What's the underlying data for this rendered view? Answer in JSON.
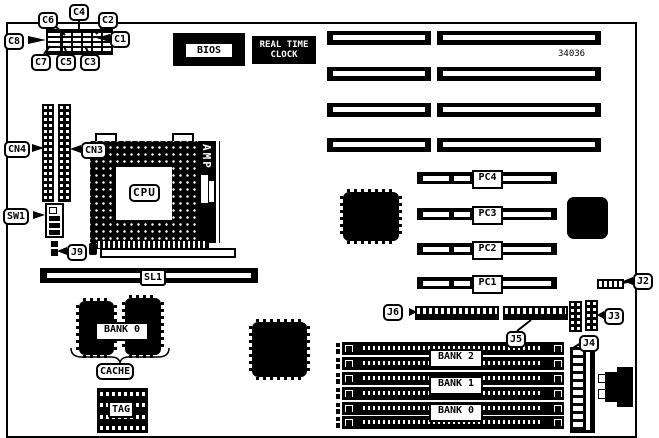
{
  "part_number": "34036",
  "jumper_labels": {
    "c1": "C1",
    "c2": "C2",
    "c3": "C3",
    "c4": "C4",
    "c5": "C5",
    "c6": "C6",
    "c7": "C7",
    "c8": "C8"
  },
  "connector_labels": {
    "cn3": "CN3",
    "cn4": "CN4",
    "sw1": "SW1",
    "j2": "J2",
    "j3": "J3",
    "j4": "J4",
    "j5": "J5",
    "j6": "J6",
    "j9": "J9",
    "sl1": "SL1"
  },
  "chip_labels": {
    "bios": "BIOS",
    "rtc_line1": "REAL TIME",
    "rtc_line2": "CLOCK",
    "cpu": "CPU",
    "amp": "AMP",
    "tag": "TAG"
  },
  "slot_labels": {
    "pci": [
      "PC4",
      "PC3",
      "PC2",
      "PC1"
    ],
    "memory_banks": [
      "BANK 2",
      "BANK 1",
      "BANK 0"
    ],
    "cache_bank": "BANK 0",
    "cache": "CACHE"
  },
  "colors": {
    "line": "#000000",
    "background": "#ffffff"
  }
}
